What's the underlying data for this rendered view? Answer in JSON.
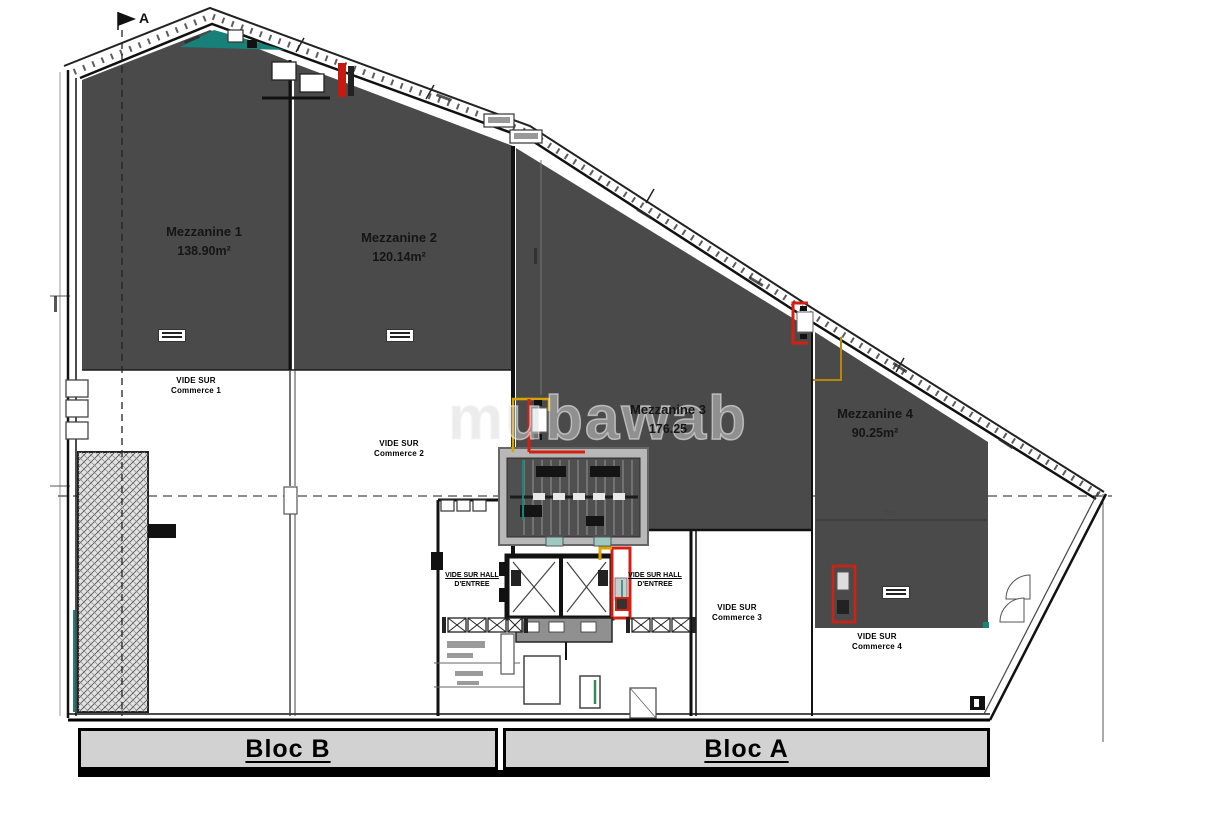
{
  "plan": {
    "watermark": "mubawab",
    "section_marker": "A",
    "mezzanines": [
      {
        "name": "Mezzanine 1",
        "area": "138.90m²"
      },
      {
        "name": "Mezzanine 2",
        "area": "120.14m²"
      },
      {
        "name": "Mezzanine 3",
        "area": "176.25"
      },
      {
        "name": "Mezzanine 4",
        "area": "90.25m²"
      }
    ],
    "voids": [
      {
        "line1": "VIDE SUR",
        "line2": "Commerce 1"
      },
      {
        "line1": "VIDE SUR",
        "line2": "Commerce 2"
      },
      {
        "line1": "VIDE SUR",
        "line2": "Commerce 3"
      },
      {
        "line1": "VIDE SUR",
        "line2": "Commerce 4"
      }
    ],
    "halls": [
      {
        "line1": "VIDE SUR HALL",
        "line2": "D'ENTREE"
      },
      {
        "line1": "VIDE SUR HALL",
        "line2": "D'ENTREE"
      }
    ],
    "misc_label": "TOL",
    "blocks": [
      {
        "label": "Bloc B"
      },
      {
        "label": "Bloc A"
      }
    ]
  },
  "colors": {
    "slab": "#4a4a4a",
    "bar_fill": "#d2d2d2",
    "accent_red": "#d42010",
    "accent_yellow": "#d9a400",
    "accent_teal": "#17857b"
  }
}
